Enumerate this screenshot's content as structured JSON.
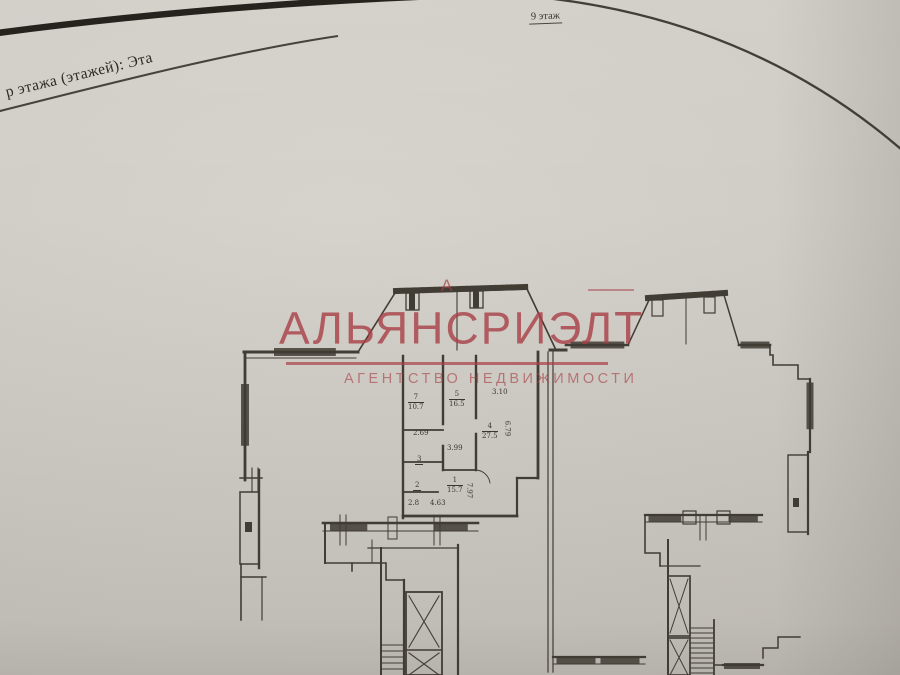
{
  "document": {
    "header_fragment": "р этажа (этажей):  Эта",
    "floor_note": "9 этаж"
  },
  "watermark": {
    "title": "АЛЬЯНСРИЭЛТ",
    "subtitle": "АГЕНТСТВО НЕДВИЖИМОСТИ",
    "stray_letter": "А",
    "color": "#a93f47"
  },
  "floorplan": {
    "rooms": [
      {
        "number": "7",
        "area": "10.7"
      },
      {
        "number": "5",
        "area": "16.5"
      },
      {
        "number": "4",
        "area": "27.5"
      },
      {
        "number": "1",
        "area": "15.7"
      },
      {
        "number": "3",
        "area": ""
      },
      {
        "number": "2",
        "area": ""
      }
    ],
    "area_labels": {
      "a269": "2.69",
      "a399": "3.99",
      "a28": "2.8",
      "a463": "4.63"
    },
    "dimensions": {
      "d679": "6.79",
      "d797": "7.97",
      "d310": "3.10"
    }
  }
}
